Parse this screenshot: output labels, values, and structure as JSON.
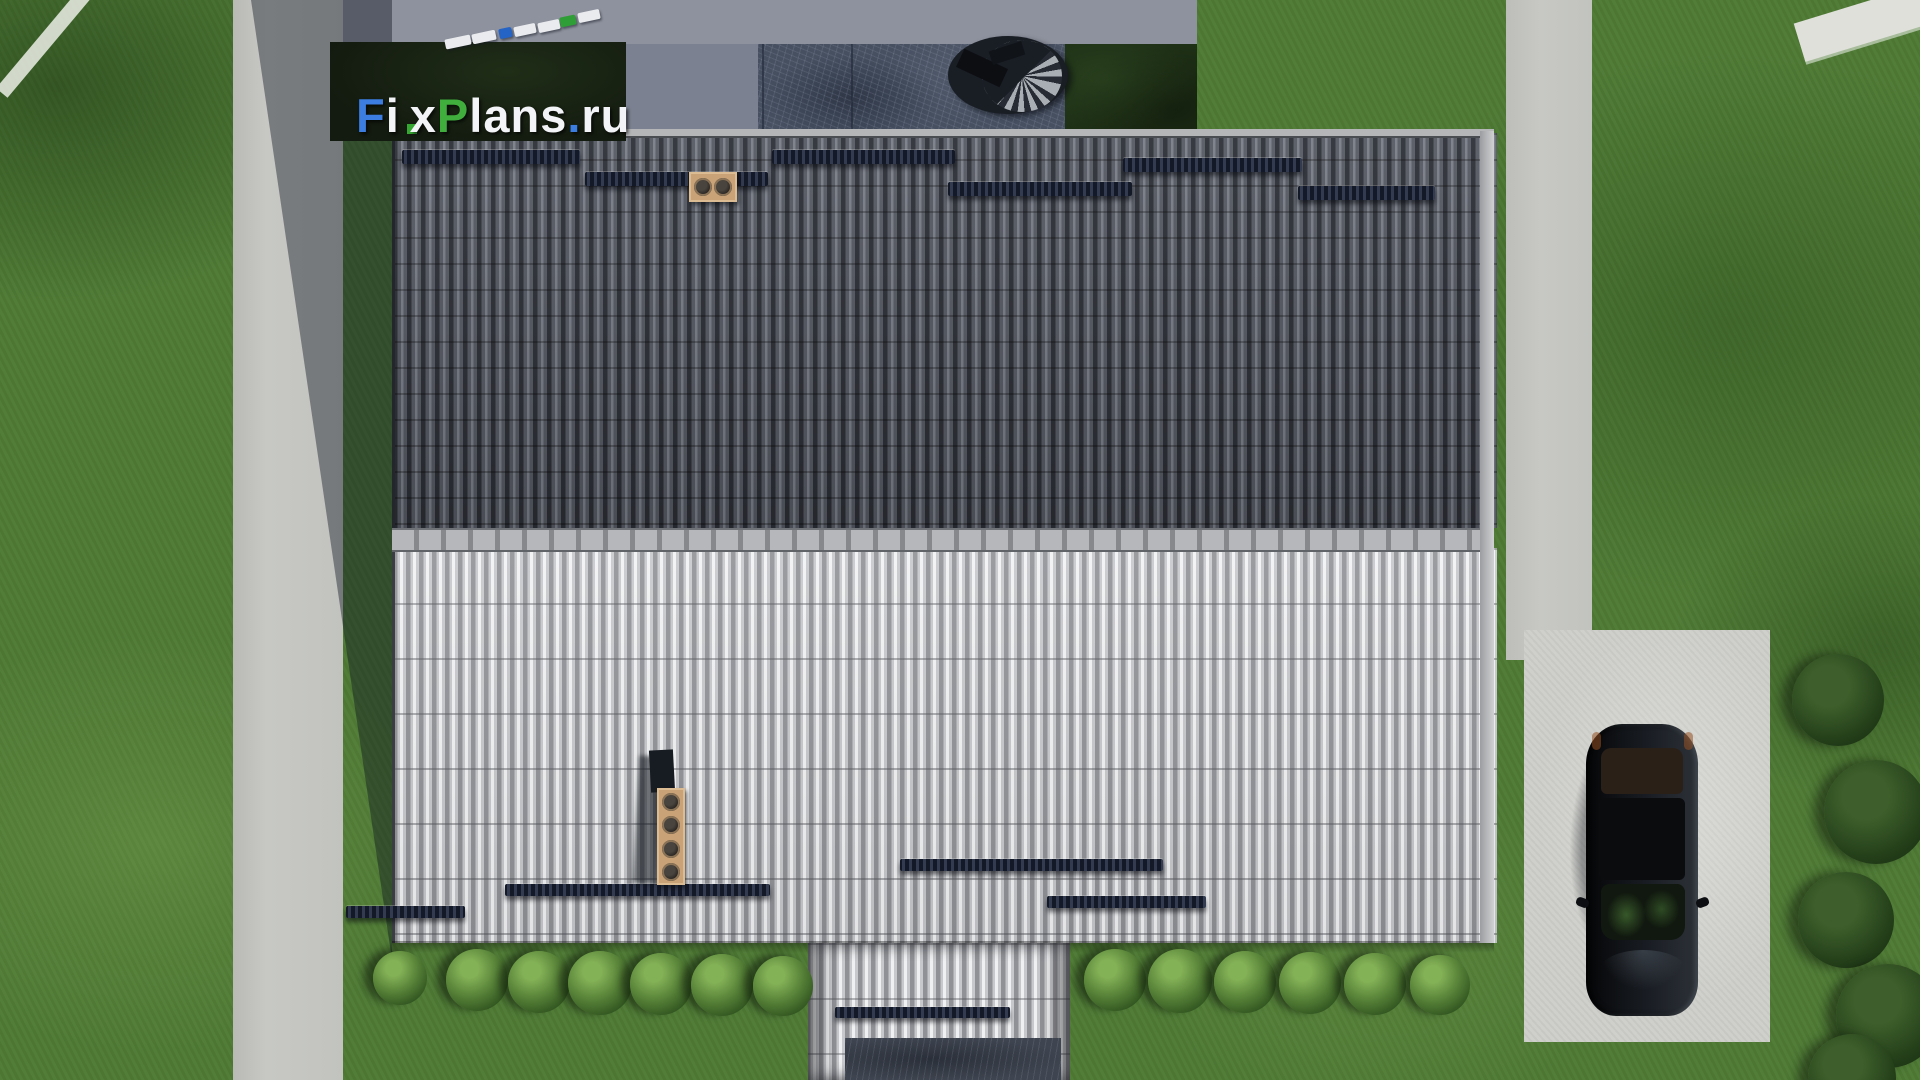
{
  "watermark": {
    "text": "FixPlans.ru",
    "parts": [
      {
        "t": "F",
        "color": "#3b7de0"
      },
      {
        "t": "i",
        "color": "#f2f4f7",
        "dot": "#35a832"
      },
      {
        "t": "x",
        "color": "#f2f4f7"
      },
      {
        "t": "P",
        "color": "#3fae3c"
      },
      {
        "t": "lans",
        "color": "#f2f4f7"
      },
      {
        "t": ".",
        "color": "#3b7de0"
      },
      {
        "t": "ru",
        "color": "#f2f4f7"
      }
    ]
  },
  "palette": {
    "grass": "#4e7a34",
    "grass_dark": "#2e4d20",
    "path": "#c7c8c4",
    "driveway": "#cdcec9",
    "pavement": "#8e929e",
    "pavement_col": "#7b8190",
    "patio": "#465061",
    "hedge": "#1e3016",
    "logo_bg": "#131a0f",
    "roof_upper": "#3e424b",
    "roof_lower": "#b2b4b7",
    "ridge": "#a7a9ac",
    "guard": "#161b27",
    "chimney": "#c9a377",
    "walkway": "#3f4550",
    "car": "#0a0c0f"
  },
  "objects": {
    "deck_blocks": [
      {
        "x": 445,
        "y": 37,
        "w": 26,
        "c": "#e9ebee"
      },
      {
        "x": 472,
        "y": 32,
        "w": 24,
        "c": "#e9ebee"
      },
      {
        "x": 499,
        "y": 28,
        "w": 13,
        "c": "#2563c4"
      },
      {
        "x": 514,
        "y": 25,
        "w": 22,
        "c": "#e9ebee"
      },
      {
        "x": 538,
        "y": 21,
        "w": 22,
        "c": "#e9ebee"
      },
      {
        "x": 560,
        "y": 16,
        "w": 16,
        "c": "#2f9e36"
      },
      {
        "x": 578,
        "y": 11,
        "w": 22,
        "c": "#e9ebee"
      }
    ],
    "snow_guards_upper": [
      {
        "x": 402,
        "y": 150,
        "w": 178,
        "h": 14
      },
      {
        "x": 585,
        "y": 172,
        "w": 183,
        "h": 14
      },
      {
        "x": 772,
        "y": 150,
        "w": 183,
        "h": 14
      },
      {
        "x": 948,
        "y": 182,
        "w": 184,
        "h": 14
      },
      {
        "x": 1123,
        "y": 158,
        "w": 179,
        "h": 14
      },
      {
        "x": 1298,
        "y": 186,
        "w": 137,
        "h": 14
      }
    ],
    "snow_guards_lower": [
      {
        "x": 346,
        "y": 906,
        "w": 119,
        "h": 12
      },
      {
        "x": 505,
        "y": 884,
        "w": 265,
        "h": 12
      },
      {
        "x": 900,
        "y": 859,
        "w": 263,
        "h": 12
      },
      {
        "x": 1047,
        "y": 896,
        "w": 159,
        "h": 12
      },
      {
        "x": 835,
        "y": 1007,
        "w": 175,
        "h": 11
      }
    ],
    "bushes": [
      {
        "x": 400,
        "y": 978,
        "s": 54
      },
      {
        "x": 477,
        "y": 980,
        "s": 62
      },
      {
        "x": 539,
        "y": 982,
        "s": 62
      },
      {
        "x": 600,
        "y": 983,
        "s": 64
      },
      {
        "x": 661,
        "y": 984,
        "s": 62
      },
      {
        "x": 722,
        "y": 985,
        "s": 62
      },
      {
        "x": 783,
        "y": 986,
        "s": 60
      },
      {
        "x": 1115,
        "y": 980,
        "s": 62
      },
      {
        "x": 1180,
        "y": 981,
        "s": 64
      },
      {
        "x": 1245,
        "y": 982,
        "s": 62
      },
      {
        "x": 1310,
        "y": 983,
        "s": 62
      },
      {
        "x": 1375,
        "y": 984,
        "s": 62
      },
      {
        "x": 1440,
        "y": 985,
        "s": 60
      }
    ],
    "edge_trees": [
      {
        "x": 1838,
        "y": 700,
        "s": 92
      },
      {
        "x": 1876,
        "y": 812,
        "s": 104
      },
      {
        "x": 1846,
        "y": 920,
        "s": 96
      },
      {
        "x": 1888,
        "y": 1016,
        "s": 104
      },
      {
        "x": 1852,
        "y": 1078,
        "s": 88
      }
    ]
  }
}
